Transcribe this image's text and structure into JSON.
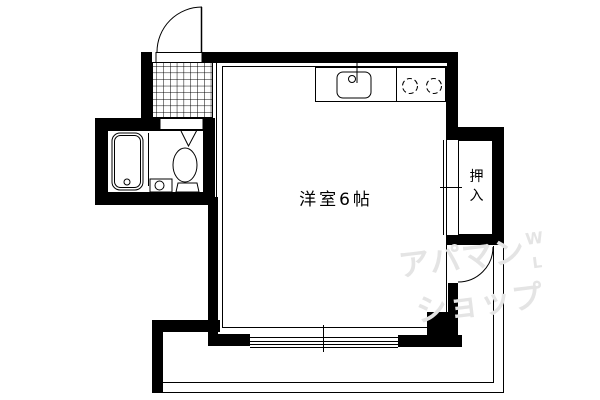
{
  "floorplan": {
    "title": "studio-apartment-floorplan",
    "room": {
      "label": "洋室6帖"
    },
    "closet": {
      "label": "押入"
    },
    "watermark": {
      "line1": "アパマン",
      "line2": "ショップ",
      "mark_top": "W",
      "mark_bottom": "L"
    },
    "colors": {
      "wall": "#000000",
      "line": "#000000",
      "background": "#ffffff",
      "watermark": "#e4e4e4"
    },
    "icons": [
      "entrance-door-icon",
      "genkan-tile-icon",
      "bathtub-icon",
      "washbasin-icon",
      "toilet-icon",
      "bathroom-door-icon",
      "kitchen-sink-icon",
      "faucet-icon",
      "stove-burners-icon",
      "closet-sliding-door-icon",
      "balcony-door-icon",
      "sliding-window-icon",
      "balcony-railing-icon"
    ]
  }
}
